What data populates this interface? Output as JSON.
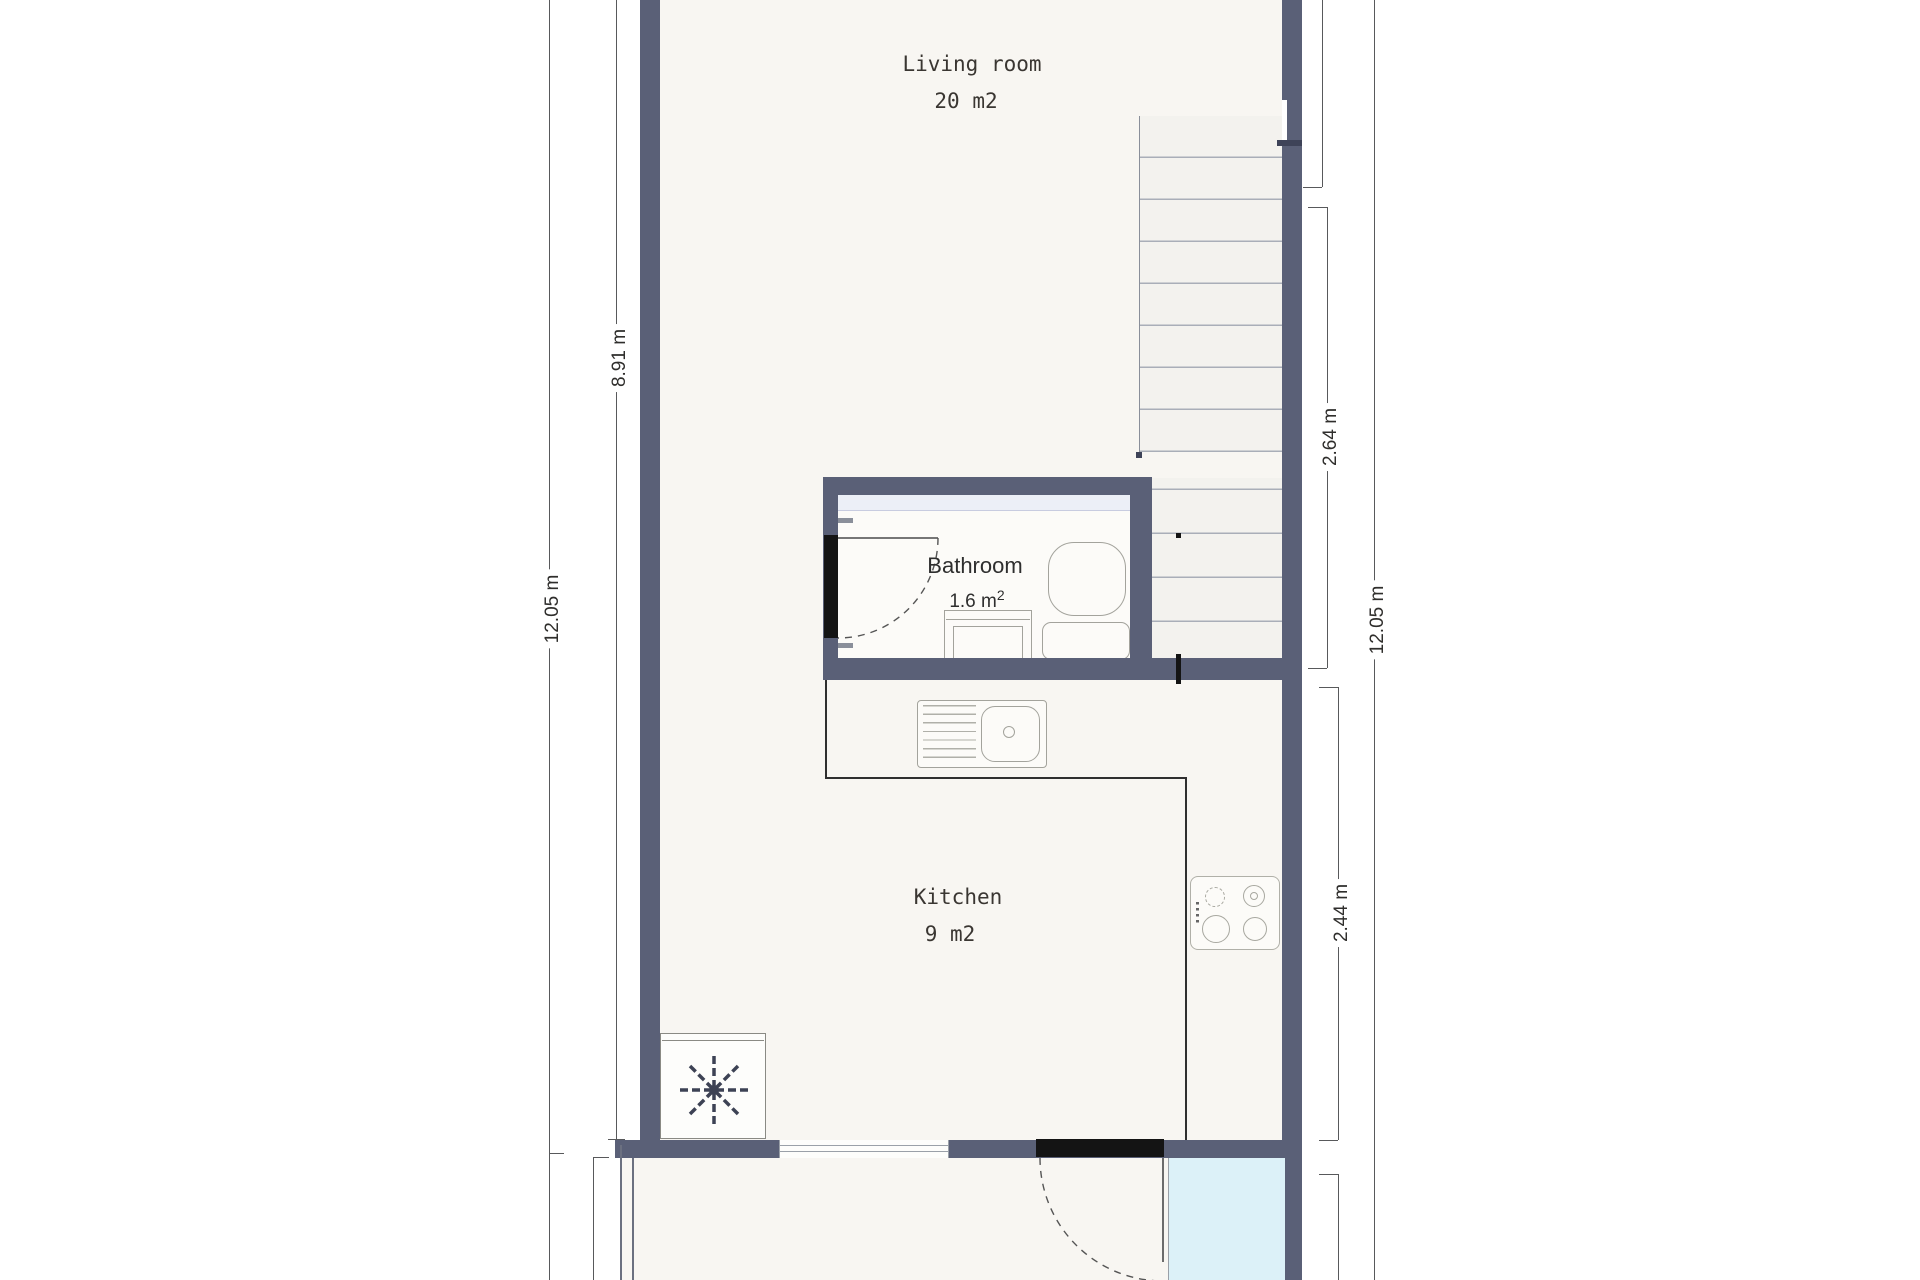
{
  "rooms": {
    "living_room": {
      "label": "Living room",
      "area": "20 m2"
    },
    "bathroom": {
      "label": "Bathroom",
      "area_main": "1.6 m",
      "area_sup": "2"
    },
    "kitchen": {
      "label": "Kitchen",
      "area": "9 m2"
    }
  },
  "dimensions": {
    "left_overall": "12.05 m",
    "left_upper": "8.91 m",
    "right_stairwell": "2.64 m",
    "right_kitchen": "2.44 m",
    "right_overall": "12.05 m"
  },
  "fixtures": [
    "staircase",
    "toilet",
    "bathroom-sink",
    "kitchen-sink",
    "stove",
    "freezer",
    "entrance-door",
    "bathroom-door",
    "window",
    "porch-glazing"
  ],
  "colors": {
    "wall": "#5a6077",
    "floor": "#f8f6f2",
    "stair_fill": "#f3f2ee",
    "glass": "#dcf1f8",
    "door": "#141414",
    "bath_band": "#eceff7"
  }
}
